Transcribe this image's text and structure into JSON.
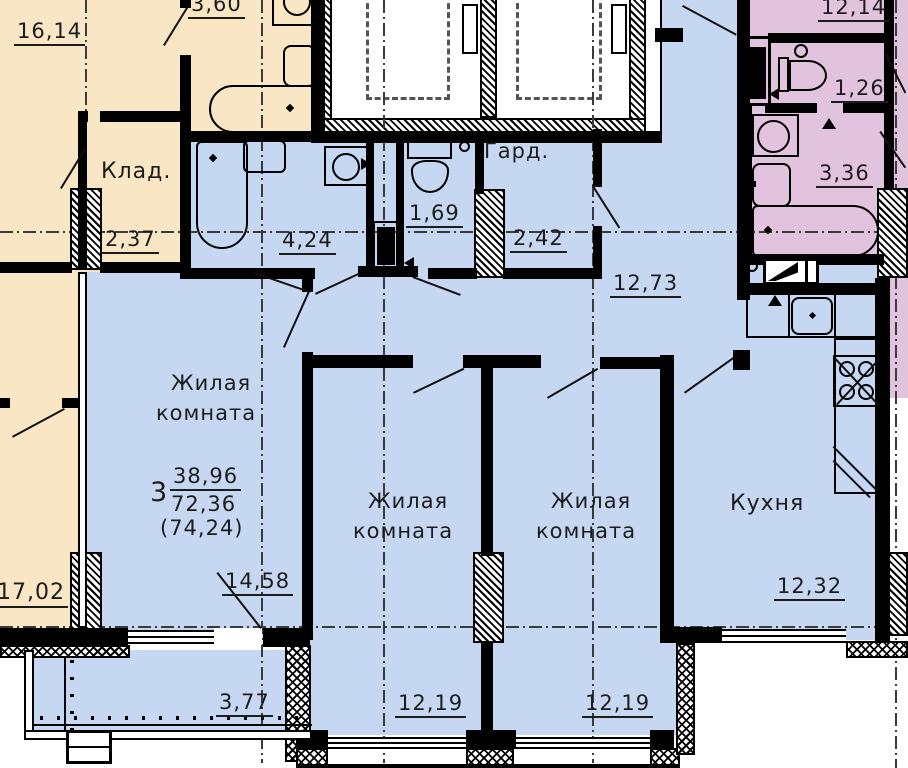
{
  "colors": {
    "beige_unit": "#f8e6c4",
    "main_unit": "#c6d7f2",
    "right_unit": "#e2c3de",
    "wall": "#000000",
    "text": "#1c1c1c"
  },
  "apartment_summary": {
    "rooms_count": "3",
    "living_area": "38,96",
    "total_area": "72,36",
    "total_with_balcony": "(74,24)"
  },
  "labels": [
    {
      "id": "area-16-14",
      "t": "16,14",
      "x": 14,
      "y": 20,
      "s": 21,
      "u": 1
    },
    {
      "id": "label-klad",
      "t": "Клад.",
      "x": 101,
      "y": 160,
      "s": 22,
      "u": 0
    },
    {
      "id": "area-2-37",
      "t": "2,37",
      "x": 102,
      "y": 228,
      "s": 21,
      "u": 1
    },
    {
      "id": "area-3-60",
      "t": "3,60",
      "x": 188,
      "y": -7,
      "s": 21,
      "u": 1
    },
    {
      "id": "area-17-02",
      "t": "17,02",
      "x": -6,
      "y": 581,
      "s": 22,
      "u": 1
    },
    {
      "id": "area-4-24",
      "t": "4,24",
      "x": 279,
      "y": 229,
      "s": 21,
      "u": 1
    },
    {
      "id": "area-1-69",
      "t": "1,69",
      "x": 406,
      "y": 202,
      "s": 21,
      "u": 1
    },
    {
      "id": "label-gard",
      "t": "Гард.",
      "x": 484,
      "y": 140,
      "s": 21,
      "u": 0
    },
    {
      "id": "area-2-42",
      "t": "2,42",
      "x": 510,
      "y": 227,
      "s": 21,
      "u": 1
    },
    {
      "id": "area-12-73",
      "t": "12,73",
      "x": 610,
      "y": 272,
      "s": 21,
      "u": 1
    },
    {
      "id": "room1-name-line1",
      "t": "Жилая",
      "x": 171,
      "y": 372,
      "s": 21,
      "u": 0
    },
    {
      "id": "room1-name-line2",
      "t": "комната",
      "x": 156,
      "y": 402,
      "s": 21,
      "u": 0
    },
    {
      "id": "summary-rooms-count",
      "t": "3",
      "x": 150,
      "y": 479,
      "s": 27,
      "u": 0
    },
    {
      "id": "summary-living-area",
      "t": "38,96",
      "x": 170,
      "y": 465,
      "s": 21,
      "u": 1
    },
    {
      "id": "summary-total-area",
      "t": "72,36",
      "x": 171,
      "y": 493,
      "s": 21,
      "u": 0
    },
    {
      "id": "summary-total-with-balcony",
      "t": "(74,24)",
      "x": 160,
      "y": 517,
      "s": 21,
      "u": 0
    },
    {
      "id": "area-14-58",
      "t": "14,58",
      "x": 222,
      "y": 570,
      "s": 21,
      "u": 1
    },
    {
      "id": "room2-name-line1",
      "t": "Жилая",
      "x": 368,
      "y": 490,
      "s": 21,
      "u": 0
    },
    {
      "id": "room2-name-line2",
      "t": "комната",
      "x": 353,
      "y": 520,
      "s": 21,
      "u": 0
    },
    {
      "id": "area-12-19-a",
      "t": "12,19",
      "x": 395,
      "y": 692,
      "s": 21,
      "u": 1
    },
    {
      "id": "room3-name-line1",
      "t": "Жилая",
      "x": 551,
      "y": 490,
      "s": 21,
      "u": 0
    },
    {
      "id": "room3-name-line2",
      "t": "комната",
      "x": 536,
      "y": 520,
      "s": 21,
      "u": 0
    },
    {
      "id": "area-12-19-b",
      "t": "12,19",
      "x": 582,
      "y": 692,
      "s": 21,
      "u": 1
    },
    {
      "id": "label-kitchen",
      "t": "Кухня",
      "x": 730,
      "y": 492,
      "s": 22,
      "u": 0
    },
    {
      "id": "area-12-32",
      "t": "12,32",
      "x": 774,
      "y": 575,
      "s": 21,
      "u": 1
    },
    {
      "id": "area-3-77",
      "t": "3,77",
      "x": 216,
      "y": 691,
      "s": 21,
      "u": 1
    },
    {
      "id": "area-12-14",
      "t": "12,14",
      "x": 818,
      "y": -4,
      "s": 21,
      "u": 1
    },
    {
      "id": "area-1-26",
      "t": "1,26",
      "x": 831,
      "y": 77,
      "s": 21,
      "u": 1
    },
    {
      "id": "area-3-36",
      "t": "3,36",
      "x": 816,
      "y": 162,
      "s": 21,
      "u": 1
    }
  ]
}
